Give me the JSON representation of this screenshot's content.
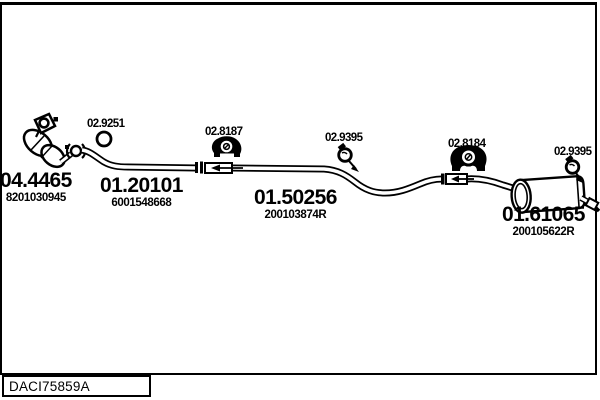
{
  "page": {
    "background": "#ffffff",
    "ink_color": "#000000"
  },
  "diagram": {
    "footer_code": "DACI75859A",
    "parts": [
      {
        "number": "04.4465",
        "ref": "8201030945"
      },
      {
        "number": "01.20101",
        "ref": "6001548668"
      },
      {
        "number": "01.50256",
        "ref": "200103874R"
      },
      {
        "number": "01.61065",
        "ref": "200105622R"
      }
    ],
    "fittings": [
      {
        "number": "02.9251"
      },
      {
        "number": "02.8187"
      },
      {
        "number": "02.9395"
      },
      {
        "number": "02.8184"
      },
      {
        "number": "02.9395"
      }
    ]
  }
}
